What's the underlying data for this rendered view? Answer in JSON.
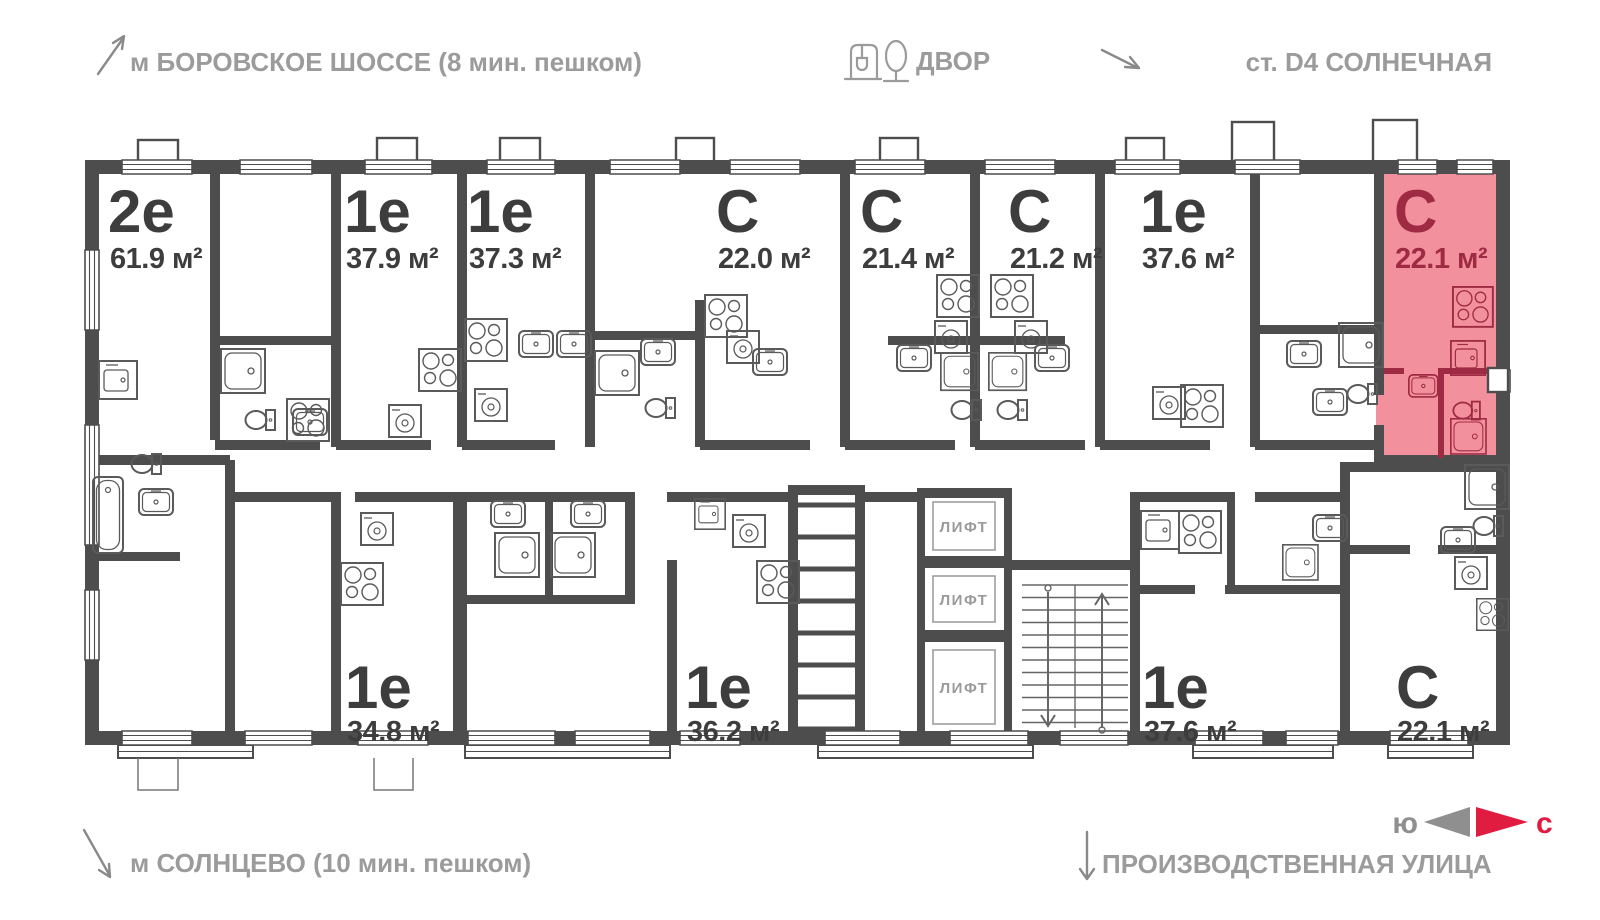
{
  "header": {
    "metro_top": "м БОРОВСКОЕ ШОССЕ (8 мин. пешком)",
    "courtyard": "ДВОР",
    "station": "ст. D4 СОЛНЕЧНАЯ"
  },
  "footer": {
    "metro_bottom": "м СОЛНЦЕВО (10 мин. пешком)",
    "street": "ПРОИЗВОДСТВЕННАЯ УЛИЦА"
  },
  "compass": {
    "south": "ю",
    "north": "с"
  },
  "core": {
    "elevator": "ЛИФТ"
  },
  "apartments": [
    {
      "type": "2е",
      "area": "61.9 м²",
      "highlighted": false
    },
    {
      "type": "1е",
      "area": "37.9 м²",
      "highlighted": false
    },
    {
      "type": "1е",
      "area": "37.3 м²",
      "highlighted": false
    },
    {
      "type": "С",
      "area": "22.0 м²",
      "highlighted": false
    },
    {
      "type": "С",
      "area": "21.4 м²",
      "highlighted": false
    },
    {
      "type": "С",
      "area": "21.2 м²",
      "highlighted": false
    },
    {
      "type": "1е",
      "area": "37.6 м²",
      "highlighted": false
    },
    {
      "type": "С",
      "area": "22.1 м²",
      "highlighted": true
    },
    {
      "type": "1е",
      "area": "34.8 м²",
      "highlighted": false
    },
    {
      "type": "1е",
      "area": "36.2 м²",
      "highlighted": false
    },
    {
      "type": "1е",
      "area": "37.6 м²",
      "highlighted": false
    },
    {
      "type": "С",
      "area": "22.1 м²",
      "highlighted": false
    }
  ],
  "colors": {
    "wall": "#4d4d4d",
    "unit_text": "#3d3d3d",
    "annotation": "#9b9b9b",
    "highlight_fill": "#f2919d",
    "highlight_text": "#9e2b43",
    "compass_north": "#e01c40",
    "compass_south": "#8f8f8f"
  }
}
